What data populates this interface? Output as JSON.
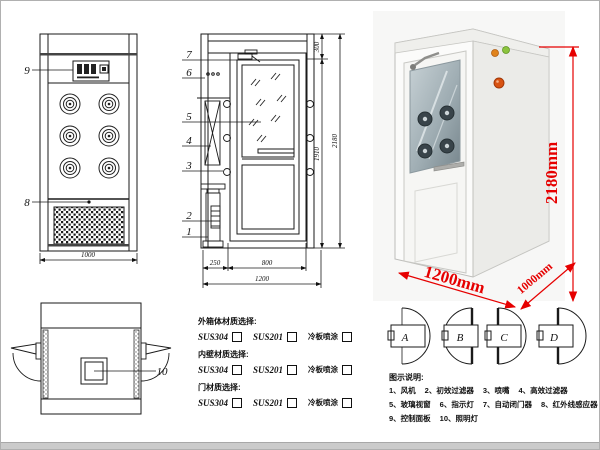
{
  "front_view": {
    "callout_control_panel": "9",
    "callout_grille": "8",
    "dim_width": "1000"
  },
  "section_view": {
    "callouts": [
      "7",
      "6",
      "5",
      "4",
      "3",
      "2",
      "1"
    ],
    "dim_top": "300",
    "dim_door_height": "1910",
    "dim_total_height": "2180",
    "dim_left": "250",
    "dim_door_width": "800",
    "dim_total_width": "1200"
  },
  "top_view": {
    "callout_lamp": "10"
  },
  "photo": {
    "dim_height": "2180mm",
    "dim_width": "1200mm",
    "dim_depth": "1000mm",
    "accent_color": "#e60000"
  },
  "door_options": [
    {
      "label": "A"
    },
    {
      "label": "B"
    },
    {
      "label": "C"
    },
    {
      "label": "D"
    }
  ],
  "materials": {
    "groups": [
      {
        "title": "外箱体材质选择:",
        "options": [
          {
            "label": "SUS304"
          },
          {
            "label": "SUS201"
          },
          {
            "label": "冷板喷涂"
          }
        ]
      },
      {
        "title": "内壁材质选择:",
        "options": [
          {
            "label": "SUS304"
          },
          {
            "label": "SUS201"
          },
          {
            "label": "冷板喷涂"
          }
        ]
      },
      {
        "title": "门材质选择:",
        "options": [
          {
            "label": "SUS304"
          },
          {
            "label": "SUS201"
          },
          {
            "label": "冷板喷涂"
          }
        ]
      }
    ]
  },
  "legend": {
    "title": "图示说明:",
    "rows": [
      [
        "1、风机",
        "2、初效过滤器",
        "3、喷嘴",
        "4、高效过滤器"
      ],
      [
        "5、玻璃视窗",
        "6、指示灯",
        "7、自动闭门器",
        "8、红外线感应器"
      ],
      [
        "9、控制面板",
        "10、照明灯"
      ]
    ]
  }
}
